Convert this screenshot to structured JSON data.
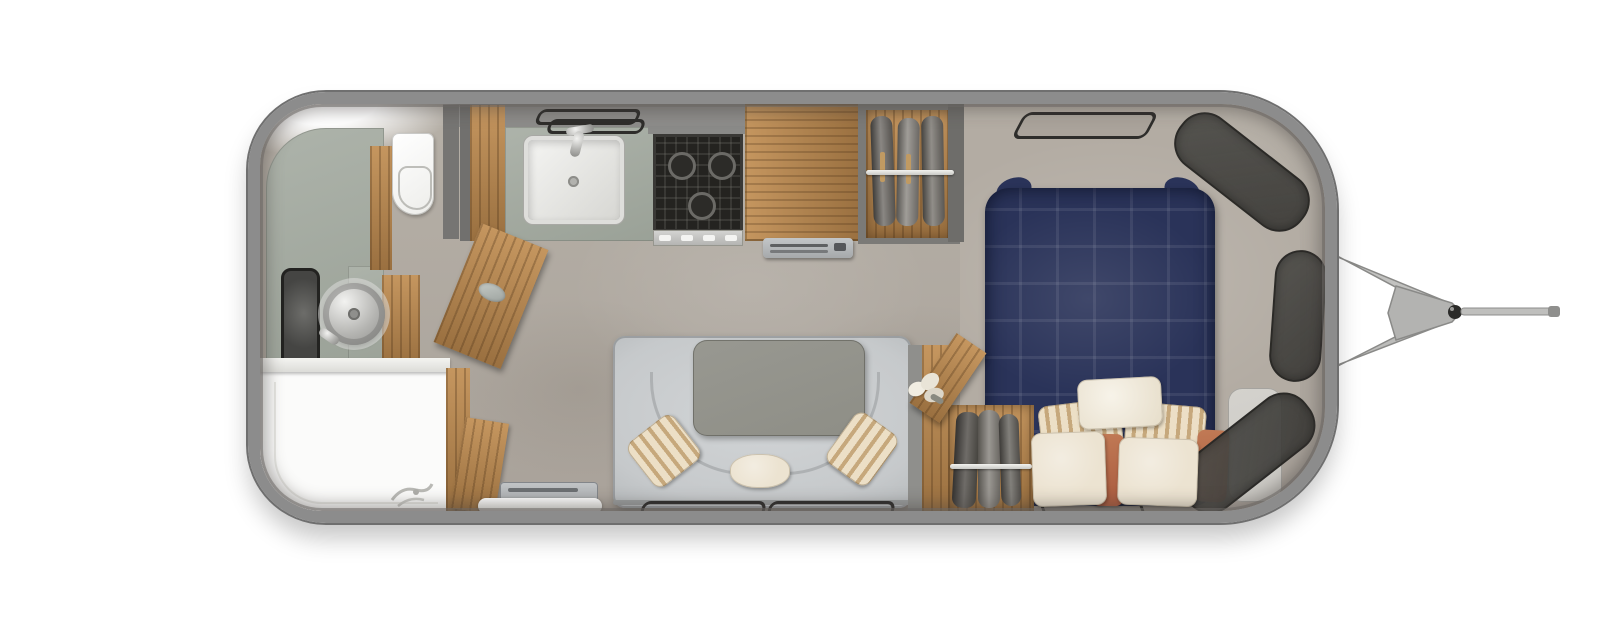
{
  "meta": {
    "kind": "travel-trailer-floor-plan",
    "view": "top-down",
    "text_visible": "none"
  },
  "palette": {
    "body-wall": "#8c8c8c",
    "body-outline": "#6f6f6f",
    "floor": "#a9a29a",
    "floor-light": "#b6b0a7",
    "sage": "#9aa197",
    "sage-light": "#adb3aa",
    "wood": "#b08552",
    "wood-light": "#c5965f",
    "wood-dark": "#9a7040",
    "navy": "#2a3359",
    "navy-dark": "#1e2542",
    "sofa-gray": "#c6c9cb",
    "table-gray": "#8e8e86",
    "cream": "#ece3d1",
    "stripe-tan": "#c6a87c",
    "rust": "#a85a3e",
    "beige-surround": "#b3aca3",
    "dark-panel": "#454440",
    "outline-dark": "#2e2d2b",
    "chrome": "#c6c6c4",
    "stove-black": "#242320",
    "shower-white": "#fbfbfa",
    "seat-gray": "#cbc9c4"
  },
  "trailer": {
    "sections": [
      {
        "id": "bathroom-rear",
        "features": [
          "vanity-counter",
          "round-vessel-sink",
          "wall-mirror",
          "toilet",
          "shower-pan",
          "shower-drain",
          "open-door"
        ]
      },
      {
        "id": "kitchen",
        "features": [
          "counter",
          "square-sink",
          "faucet",
          "window-above-sink",
          "three-burner-stove",
          "refrigerator-cabinet",
          "vent-grille",
          "pantry-cabinet"
        ]
      },
      {
        "id": "kitchen-wardrobe",
        "features": [
          "hanging-rod",
          "clothes-bundles",
          "hangers"
        ]
      },
      {
        "id": "lounge",
        "features": [
          "u-shaped-sofa",
          "pedestal-table",
          "accent-pillows",
          "side-windows"
        ]
      },
      {
        "id": "corner-wardrobe",
        "features": [
          "angled-open-door",
          "hanging-rod",
          "clothes-bundles",
          "flower-bouquet"
        ]
      },
      {
        "id": "bedroom-front",
        "features": [
          "double-bed-tufted",
          "pillow-arrangement",
          "bedside-seat",
          "wraparound-front-panels",
          "roof-window-front",
          "roof-window-rear"
        ]
      },
      {
        "id": "entry",
        "features": [
          "entry-step",
          "threshold"
        ]
      },
      {
        "id": "hitch",
        "features": [
          "a-frame-bars",
          "coupler-plate",
          "coupler-ball",
          "jack-rod"
        ]
      }
    ],
    "counts": {
      "stove_burners": 3,
      "sofa_pillows": 3,
      "bed_pillows": 7,
      "kitchen_wardrobe_clothes_bundles": 3,
      "lounge_window_outlines": 2,
      "front_dark_panel_segments": 3,
      "bedroom_window_outlines": 2
    }
  }
}
